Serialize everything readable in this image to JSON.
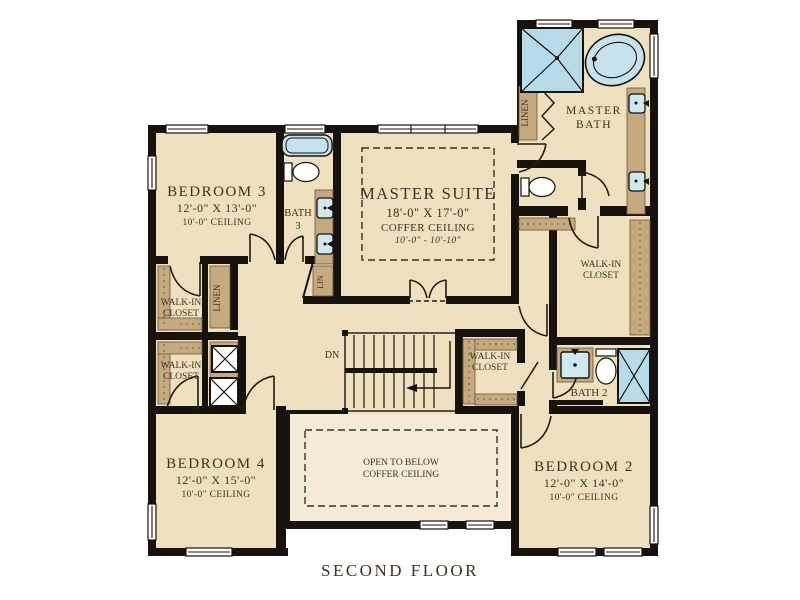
{
  "title": "SECOND FLOOR",
  "rooms": {
    "bedroom3": {
      "name": "BEDROOM 3",
      "dims": "12'-0\" X 13'-0\"",
      "ceiling": "10'-0\" CEILING"
    },
    "bedroom4": {
      "name": "BEDROOM 4",
      "dims": "12'-0\" X 15'-0\"",
      "ceiling": "10'-0\" CEILING"
    },
    "bedroom2": {
      "name": "BEDROOM 2",
      "dims": "12'-0\" X 14'-0\"",
      "ceiling": "10'-0\" CEILING"
    },
    "master_suite": {
      "name": "MASTER SUITE",
      "dims": "18'-0\" X 17'-0\"",
      "ceiling": "COFFER CEILING",
      "height": "10'-0\" - 10'-10\""
    },
    "master_bath": {
      "line1": "MASTER",
      "line2": "BATH"
    },
    "bath3": {
      "line1": "BATH",
      "line2": "3"
    },
    "bath2": {
      "name": "BATH 2"
    },
    "walk_in_closet": {
      "line1": "WALK-IN",
      "line2": "CLOSET"
    },
    "open_to_below": {
      "line1": "OPEN TO BELOW",
      "line2": "COFFER CEILING"
    },
    "linen": "LINEN",
    "lin": "LIN",
    "dn": "DN"
  },
  "colors": {
    "wall": "#17120d",
    "floor": "#efe1bf",
    "floor_light": "#f4ecd8",
    "casework_tan": "#c6a97e",
    "fixture_blue": "#c5e2ee",
    "shower_blue": "#b7dbea",
    "text": "#3e3022"
  }
}
